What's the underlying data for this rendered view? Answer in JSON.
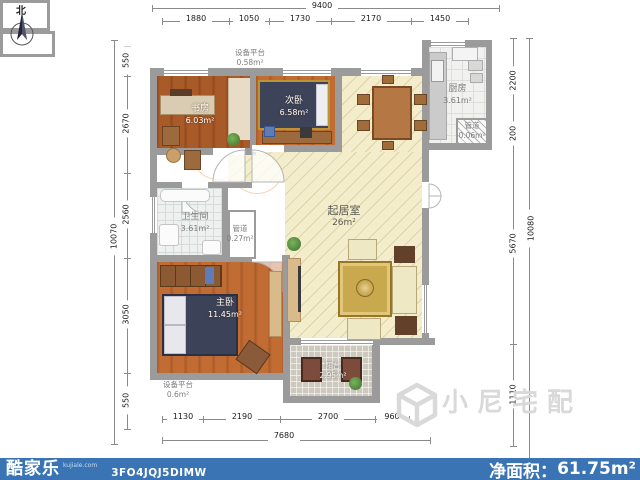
{
  "compass": {
    "north_label": "北"
  },
  "rooms": {
    "equip_top": {
      "name": "设备平台",
      "area": "0.58m²"
    },
    "study": {
      "name": "书房",
      "area": "6.03m²"
    },
    "bedroom2": {
      "name": "次卧",
      "area": "6.58m²"
    },
    "kitchen": {
      "name": "厨房",
      "area": "3.61m²"
    },
    "duct_kitchen": {
      "name": "管道",
      "area": "0.06m²"
    },
    "bathroom": {
      "name": "卫生间",
      "area": "3.61m²"
    },
    "duct_bath": {
      "name": "管道",
      "area": "0.27m²"
    },
    "living": {
      "name": "起居室",
      "area": "26m²"
    },
    "master": {
      "name": "主卧",
      "area": "11.45m²"
    },
    "equip_bottom": {
      "name": "设备平台",
      "area": "0.6m²"
    },
    "balcony": {
      "name": "阳台",
      "area": "2.95m²"
    }
  },
  "dimensions": {
    "top_total": "9400",
    "top_segments": [
      "1880",
      "1050",
      "1730",
      "2170",
      "1450"
    ],
    "left_total": "10070",
    "left_segments": [
      "550",
      "2670",
      "2560",
      "3050",
      "550"
    ],
    "right_total": "10080",
    "right_segments": [
      "2200",
      "200",
      "5670",
      "1110"
    ],
    "bottom_total": "7680",
    "bottom_segments": [
      "1130",
      "2190",
      "2700",
      "960"
    ]
  },
  "footer": {
    "logo_text": "酷家乐",
    "logo_sub": "kujiale.com",
    "plan_code": "3FO4JQJ5DIMW",
    "net_area_label": "净面积：",
    "net_area_value": "61.75m²"
  },
  "watermark": {
    "text": "小尼宅配"
  },
  "colors": {
    "bar_blue": "#3a74b4",
    "wall_grey": "#9b9b9b",
    "living_floor": "#f4edcb",
    "wood_floor": "#b06a32"
  }
}
